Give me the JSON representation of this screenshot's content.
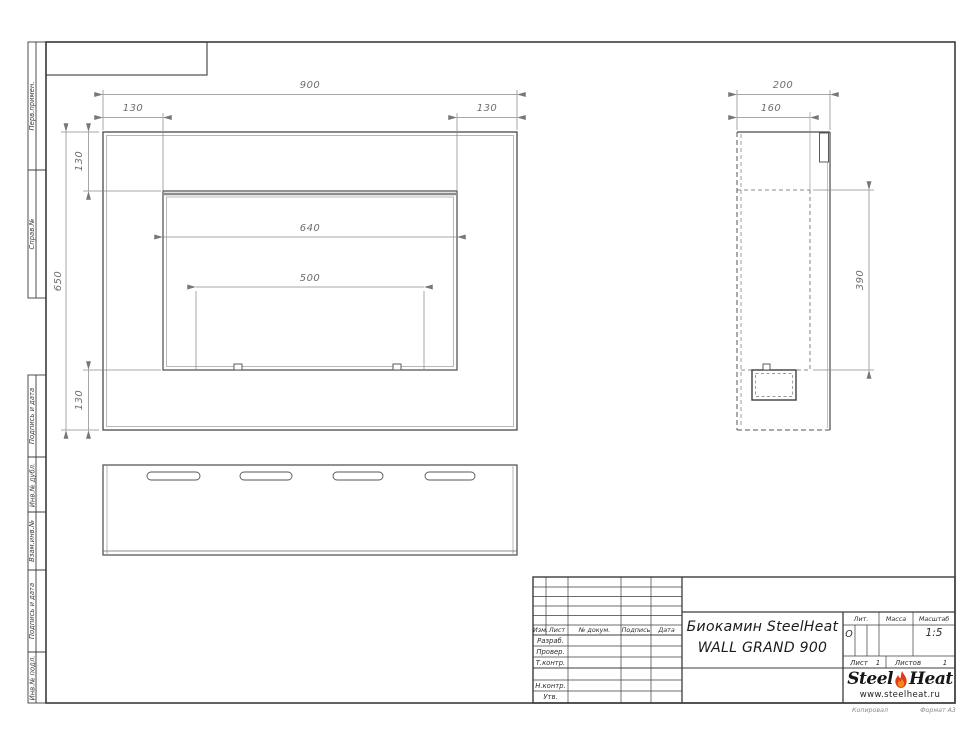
{
  "margin_labels": [
    "Перв.примен.",
    "Справ.№",
    "Подпись и дата",
    "Инв.№ дубл.",
    "Взам.инв.№",
    "Подпись и дата",
    "Инв.№ подл."
  ],
  "dims": {
    "front": {
      "overall_width": "900",
      "flange_left": "130",
      "flange_right": "130",
      "flange_top": "130",
      "flange_bottom": "130",
      "overall_height": "650",
      "opening_width": "640",
      "burner_width": "500"
    },
    "side": {
      "depth": "200",
      "inner_depth": "160",
      "opening_height": "390"
    }
  },
  "title_block": {
    "header": [
      "Изм.",
      "Лист",
      "№ докум.",
      "Подпись",
      "Дата"
    ],
    "rows": [
      "Разраб.",
      "Провер.",
      "Т.контр.",
      "Н.контр.",
      "Утв."
    ],
    "product_line1": "Биокамин SteelHeat",
    "product_line2": "WALL GRAND 900",
    "lit_label": "Лит.",
    "lit_value": "О",
    "mass_label": "Масса",
    "scale_label": "Масштаб",
    "scale_value": "1:5",
    "sheet_label": "Лист",
    "sheet_value": "1",
    "sheets_label": "Листов",
    "sheets_value": "1",
    "logo": {
      "steel": "Steel",
      "heat": "Heat",
      "website": "www.steelheat.ru"
    },
    "copied_label": "Копировал",
    "format_label": "Формат А3"
  },
  "colors": {
    "line_dark": "#3c3c3c",
    "line_mid": "#4a4a4a",
    "line_thin": "#9a9a9a",
    "dim": "#8a8a8a",
    "flame_red": "#e23b18",
    "flame_orange": "#f08a1d"
  }
}
